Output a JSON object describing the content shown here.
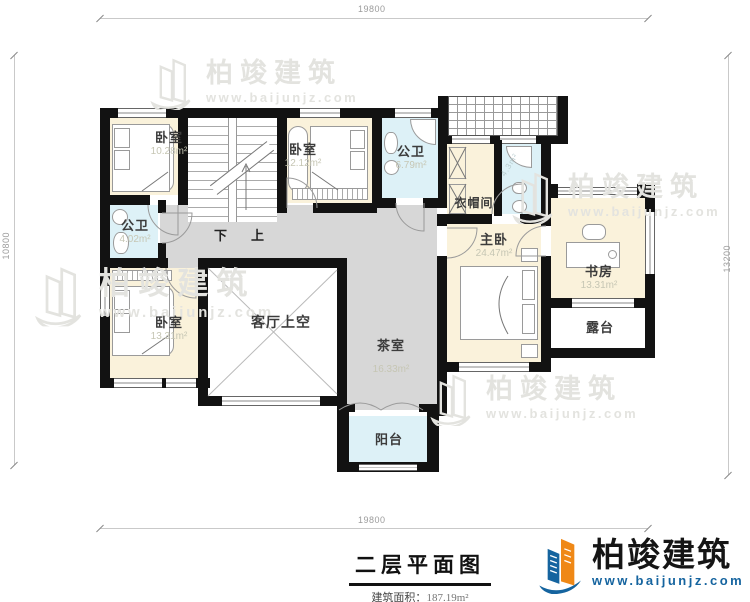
{
  "dimensions": {
    "top": "19800",
    "bottom": "19800",
    "left": "10800",
    "right": "13200"
  },
  "rooms": {
    "bedroom_tl": {
      "label": "卧室",
      "area": "10.28m²"
    },
    "bedroom_tm": {
      "label": "卧室",
      "area": "12.12m²"
    },
    "bath_top": {
      "label": "公卫",
      "area": "6.79m²"
    },
    "bath_left": {
      "label": "公卫",
      "area": "4.02m²"
    },
    "cloakroom": {
      "label": "衣帽间"
    },
    "bath_ensuite": {
      "area": "4.3m²"
    },
    "master": {
      "label": "主卧",
      "area": "24.47m²"
    },
    "study": {
      "label": "书房",
      "area": "13.31m²"
    },
    "terrace": {
      "label": "露台"
    },
    "bedroom_bl": {
      "label": "卧室",
      "area": "13.31m²"
    },
    "living_void": {
      "label": "客厅上空"
    },
    "tea_room": {
      "label": "茶室",
      "area": "16.33m²"
    },
    "balcony": {
      "label": "阳台"
    }
  },
  "stairs": {
    "down": "下",
    "up": "上"
  },
  "footer": {
    "title": "二层平面图",
    "area_label": "建筑面积：",
    "area_value": "187.19m²"
  },
  "brand": {
    "name": "柏竣建筑",
    "site": "www.baijunjz.com"
  },
  "colors": {
    "cream": "#FAF2DB",
    "blue": "#DDF1F7",
    "gray": "#D7D7D7",
    "wall": "#121212",
    "brandblue": "#15649f",
    "brandorange": "#ef8816"
  }
}
